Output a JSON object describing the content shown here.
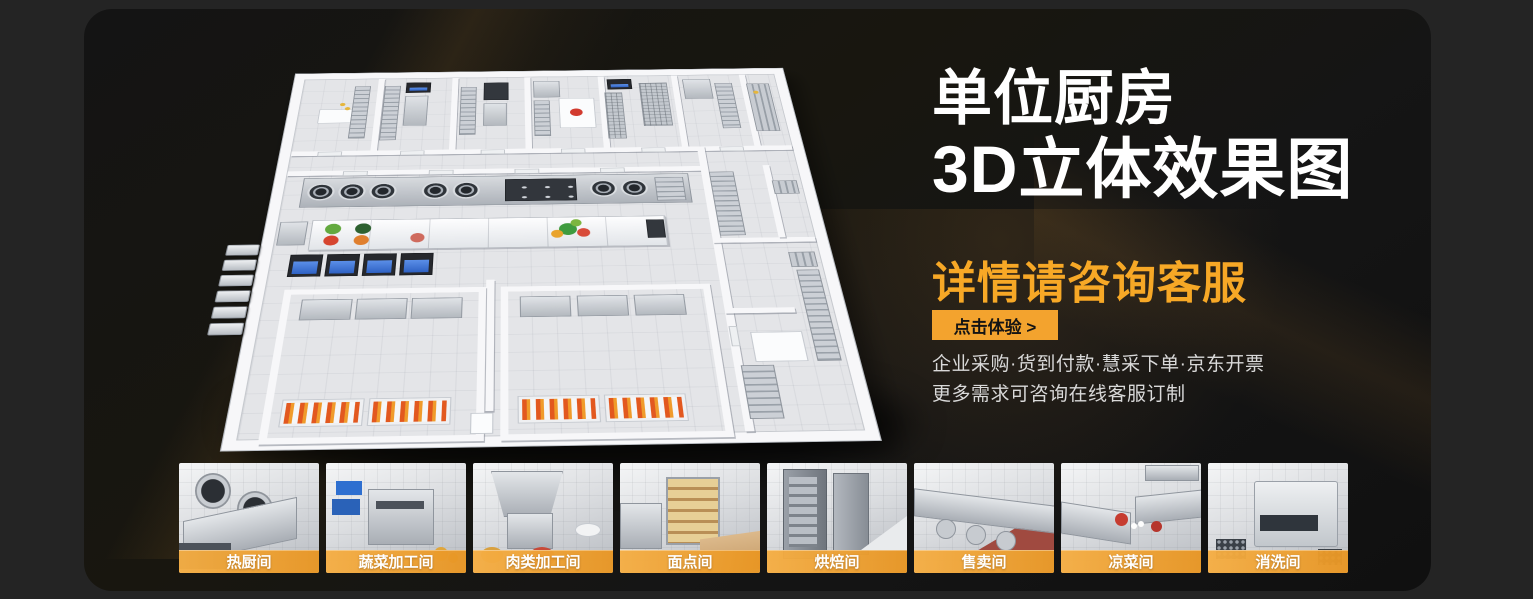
{
  "theme": {
    "outer_bg": "#242424",
    "panel_bg": "#151515",
    "accent_orange": "#F7A826",
    "cta_bg": "#F3A32E",
    "cta_text": "#141414",
    "label_band_left": "#F5AE44",
    "label_band_right": "#E89624",
    "title_color": "#FFFFFF",
    "info_color": "#D9D9D9"
  },
  "hero": {
    "title_line1": "单位厨房",
    "title_line2": "3D立体效果图",
    "subtitle": "详情请咨询客服",
    "cta_label": "点击体验 >",
    "info_line1": "企业采购·货到付款·慧采下单·京东开票",
    "info_line2": "更多需求可咨询在线客服订制"
  },
  "thumbnails": [
    {
      "label": "热厨间"
    },
    {
      "label": "蔬菜加工间"
    },
    {
      "label": "肉类加工间"
    },
    {
      "label": "面点间"
    },
    {
      "label": "烘焙间"
    },
    {
      "label": "售卖间"
    },
    {
      "label": "凉菜间"
    },
    {
      "label": "消洗间"
    }
  ]
}
